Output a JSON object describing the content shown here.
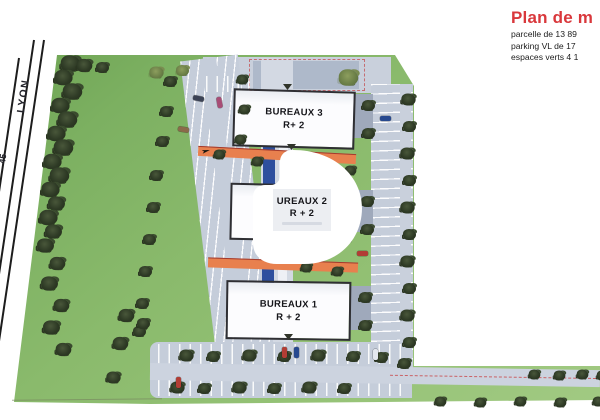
{
  "legend": {
    "title": "Plan de m",
    "lines": [
      "parcelle de 13 89",
      "parking VL de 17",
      "espaces verts 4 1"
    ]
  },
  "roads": {
    "main_label": "LYON",
    "edge_label": "45"
  },
  "buildings": [
    {
      "id": "bureaux-3",
      "label": "BUREAUX 3",
      "sub": "R+ 2"
    },
    {
      "id": "bureaux-2",
      "label": "UREAUX 2",
      "sub": "R + 2"
    },
    {
      "id": "bureaux-1",
      "label": "BUREAUX 1",
      "sub": "R + 2"
    }
  ],
  "colors": {
    "title_red": "#d9383c",
    "grass": "#8aba6c",
    "pavement": "#c5cdda",
    "path_orange": "#e8804e",
    "water_blue": "#2e4f9e",
    "tree_dark": "#2e3a25",
    "dash_red": "#c83232",
    "building_fill": "#fcfcfe",
    "building_border": "#2f2f33"
  },
  "map": {
    "trees": [
      {
        "x": 64,
        "y": 58,
        "s": 1.5
      },
      {
        "x": 57,
        "y": 72,
        "s": 1.4
      },
      {
        "x": 66,
        "y": 86,
        "s": 1.5
      },
      {
        "x": 54,
        "y": 100,
        "s": 1.4
      },
      {
        "x": 61,
        "y": 114,
        "s": 1.5
      },
      {
        "x": 50,
        "y": 128,
        "s": 1.4
      },
      {
        "x": 57,
        "y": 142,
        "s": 1.5
      },
      {
        "x": 46,
        "y": 156,
        "s": 1.4
      },
      {
        "x": 53,
        "y": 170,
        "s": 1.5
      },
      {
        "x": 44,
        "y": 184,
        "s": 1.4
      },
      {
        "x": 50,
        "y": 198,
        "s": 1.3
      },
      {
        "x": 42,
        "y": 212,
        "s": 1.4
      },
      {
        "x": 47,
        "y": 226,
        "s": 1.3
      },
      {
        "x": 39,
        "y": 240,
        "s": 1.3
      },
      {
        "x": 51,
        "y": 258,
        "s": 1.2
      },
      {
        "x": 43,
        "y": 278,
        "s": 1.3
      },
      {
        "x": 55,
        "y": 300,
        "s": 1.2
      },
      {
        "x": 45,
        "y": 322,
        "s": 1.3
      },
      {
        "x": 57,
        "y": 344,
        "s": 1.2
      },
      {
        "x": 78,
        "y": 60,
        "s": 1.2
      },
      {
        "x": 96,
        "y": 62,
        "s": 1.0
      },
      {
        "x": 150,
        "y": 67,
        "s": 1.1,
        "v": "olive"
      },
      {
        "x": 176,
        "y": 65,
        "s": 1.0,
        "v": "olive"
      },
      {
        "x": 342,
        "y": 72,
        "s": 1.5,
        "v": "olive"
      },
      {
        "x": 164,
        "y": 76,
        "s": 1
      },
      {
        "x": 160,
        "y": 106,
        "s": 1
      },
      {
        "x": 156,
        "y": 136,
        "s": 1
      },
      {
        "x": 150,
        "y": 170,
        "s": 1
      },
      {
        "x": 147,
        "y": 202,
        "s": 1
      },
      {
        "x": 143,
        "y": 234,
        "s": 1
      },
      {
        "x": 139,
        "y": 266,
        "s": 1
      },
      {
        "x": 136,
        "y": 298,
        "s": 1
      },
      {
        "x": 133,
        "y": 326,
        "s": 1
      },
      {
        "x": 236,
        "y": 74,
        "s": 0.9
      },
      {
        "x": 238,
        "y": 104,
        "s": 0.9
      },
      {
        "x": 234,
        "y": 134,
        "s": 0.9
      },
      {
        "x": 213,
        "y": 149,
        "s": 0.9
      },
      {
        "x": 251,
        "y": 156,
        "s": 0.9
      },
      {
        "x": 344,
        "y": 165,
        "s": 0.9
      },
      {
        "x": 300,
        "y": 262,
        "s": 0.9
      },
      {
        "x": 331,
        "y": 266,
        "s": 0.9
      },
      {
        "x": 362,
        "y": 100,
        "s": 1
      },
      {
        "x": 362,
        "y": 128,
        "s": 1
      },
      {
        "x": 361,
        "y": 196,
        "s": 1
      },
      {
        "x": 361,
        "y": 224,
        "s": 1
      },
      {
        "x": 359,
        "y": 292,
        "s": 1
      },
      {
        "x": 359,
        "y": 320,
        "s": 1
      },
      {
        "x": 402,
        "y": 94,
        "s": 1.1
      },
      {
        "x": 403,
        "y": 121,
        "s": 1
      },
      {
        "x": 401,
        "y": 148,
        "s": 1.1
      },
      {
        "x": 403,
        "y": 175,
        "s": 1
      },
      {
        "x": 401,
        "y": 202,
        "s": 1.1
      },
      {
        "x": 403,
        "y": 229,
        "s": 1
      },
      {
        "x": 401,
        "y": 256,
        "s": 1.1
      },
      {
        "x": 403,
        "y": 283,
        "s": 1
      },
      {
        "x": 401,
        "y": 310,
        "s": 1.1
      },
      {
        "x": 403,
        "y": 337,
        "s": 1
      },
      {
        "x": 398,
        "y": 358,
        "s": 1
      },
      {
        "x": 180,
        "y": 350,
        "s": 1.1
      },
      {
        "x": 207,
        "y": 351,
        "s": 1
      },
      {
        "x": 243,
        "y": 350,
        "s": 1.1
      },
      {
        "x": 278,
        "y": 351,
        "s": 1
      },
      {
        "x": 312,
        "y": 350,
        "s": 1.1
      },
      {
        "x": 347,
        "y": 351,
        "s": 1
      },
      {
        "x": 375,
        "y": 352,
        "s": 1
      },
      {
        "x": 171,
        "y": 382,
        "s": 1.1
      },
      {
        "x": 198,
        "y": 383,
        "s": 1
      },
      {
        "x": 233,
        "y": 382,
        "s": 1.1
      },
      {
        "x": 268,
        "y": 383,
        "s": 1
      },
      {
        "x": 303,
        "y": 382,
        "s": 1.1
      },
      {
        "x": 338,
        "y": 383,
        "s": 1
      },
      {
        "x": 528,
        "y": 369,
        "s": 0.9
      },
      {
        "x": 553,
        "y": 370,
        "s": 0.9
      },
      {
        "x": 576,
        "y": 369,
        "s": 0.9
      },
      {
        "x": 596,
        "y": 370,
        "s": 0.9
      },
      {
        "x": 434,
        "y": 396,
        "s": 0.9
      },
      {
        "x": 474,
        "y": 397,
        "s": 0.9
      },
      {
        "x": 514,
        "y": 396,
        "s": 0.9
      },
      {
        "x": 554,
        "y": 397,
        "s": 0.9
      },
      {
        "x": 592,
        "y": 396,
        "s": 0.9
      },
      {
        "x": 120,
        "y": 310,
        "s": 1.2
      },
      {
        "x": 114,
        "y": 338,
        "s": 1.2
      },
      {
        "x": 107,
        "y": 372,
        "s": 1.1
      },
      {
        "x": 137,
        "y": 318,
        "s": 1.0
      }
    ],
    "cars": [
      {
        "x": 193,
        "y": 96,
        "c": "#3b4254",
        "r": 12
      },
      {
        "x": 214,
        "y": 100,
        "c": "#a84d76",
        "r": 80
      },
      {
        "x": 178,
        "y": 127,
        "c": "#8a6a4a",
        "r": 10
      },
      {
        "x": 380,
        "y": 116,
        "c": "#27498f",
        "r": 0
      },
      {
        "x": 357,
        "y": 251,
        "c": "#b23d35",
        "r": 0
      },
      {
        "x": 279,
        "y": 350,
        "c": "#b23d35",
        "r": 90
      },
      {
        "x": 291,
        "y": 350,
        "c": "#27498f",
        "r": 90
      },
      {
        "x": 370,
        "y": 352,
        "c": "#e4e8ef",
        "r": 90
      },
      {
        "x": 173,
        "y": 380,
        "c": "#b23d35",
        "r": 90
      }
    ]
  }
}
